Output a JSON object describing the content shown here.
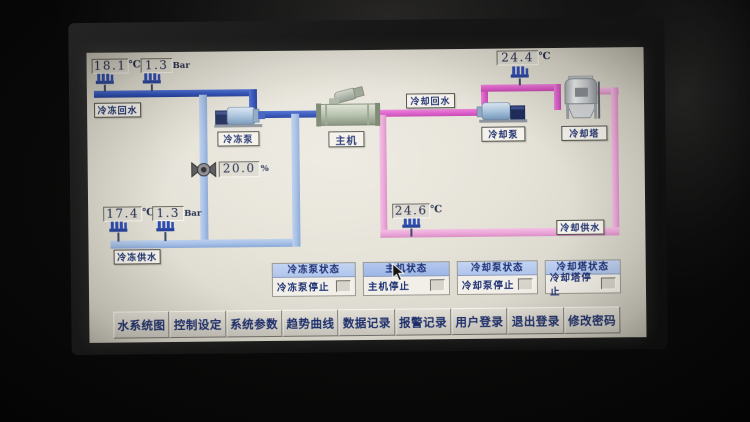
{
  "diagram": {
    "chilled": {
      "return_label": "冷冻回水",
      "supply_label": "冷冻供水",
      "pump_label": "冷冻泵",
      "chiller_label": "主机",
      "return_temp": "18.1",
      "return_temp_unit": "℃",
      "return_pressure": "1.3",
      "return_pressure_unit": "Bar",
      "supply_temp": "17.4",
      "supply_temp_unit": "℃",
      "supply_pressure": "1.3",
      "supply_pressure_unit": "Bar",
      "valve_opening": "20.0",
      "valve_unit": "%"
    },
    "cooling": {
      "return_label": "冷却回水",
      "supply_label": "冷却供水",
      "pump_label": "冷却泵",
      "tower_label": "冷却塔",
      "return_temp": "24.4",
      "return_temp_unit": "℃",
      "supply_temp": "24.6",
      "supply_temp_unit": "℃"
    }
  },
  "status_panels": [
    {
      "title": "冷冻泵状态",
      "status": "冷冻泵停止"
    },
    {
      "title": "主机状态",
      "status": "主机停止"
    },
    {
      "title": "冷却泵状态",
      "status": "冷却泵停止"
    },
    {
      "title": "冷却塔状态",
      "status": "冷却塔停止"
    }
  ],
  "menu": [
    {
      "label": "水系统图"
    },
    {
      "label": "控制设定"
    },
    {
      "label": "系统参数"
    },
    {
      "label": "趋势曲线"
    },
    {
      "label": "数据记录"
    },
    {
      "label": "报警记录"
    },
    {
      "label": "用户登录"
    },
    {
      "label": "退出登录"
    },
    {
      "label": "修改密码"
    }
  ],
  "colors": {
    "chilled_return_pipe": "#2b50c0",
    "chilled_supply_pipe": "#a2bee8",
    "cooling_return_pipe": "#e159cd",
    "cooling_supply_pipe": "#eda5d9",
    "panel_header": "#aec5ee",
    "text_navy": "#1b2f77",
    "screen_bg": "#e6e3d9"
  }
}
